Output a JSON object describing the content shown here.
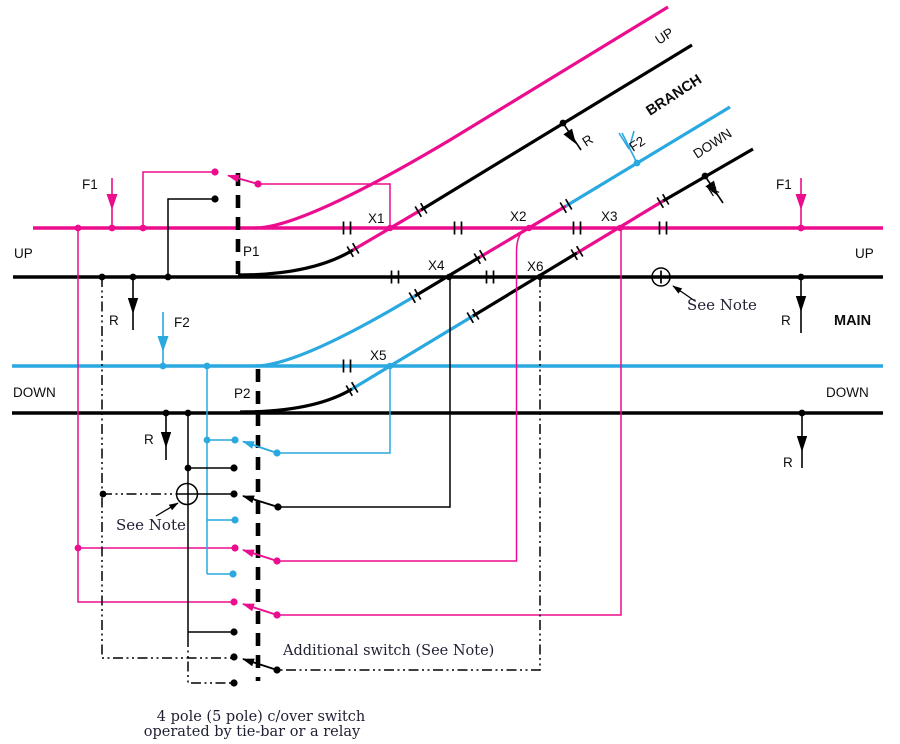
{
  "colors": {
    "magenta": "#EB0D8E",
    "blue": "#2AA9E0",
    "line": "#000000"
  },
  "tracks": {
    "up": "UP",
    "down": "DOWN",
    "main": "MAIN",
    "branch": "BRANCH"
  },
  "feeds": {
    "f1": "F1",
    "f2": "F2"
  },
  "returns": {
    "r": "R"
  },
  "sections": {
    "x1": "X1",
    "x2": "X2",
    "x3": "X3",
    "x4": "X4",
    "x5": "X5",
    "x6": "X6"
  },
  "points": {
    "p1": "P1",
    "p2": "P2"
  },
  "notes": {
    "see_note": "See Note",
    "additional_switch": "Additional switch (See Note)"
  },
  "caption": {
    "line1": "4 pole (5 pole) c/over switch",
    "line2": "operated by tie-bar or a relay"
  }
}
